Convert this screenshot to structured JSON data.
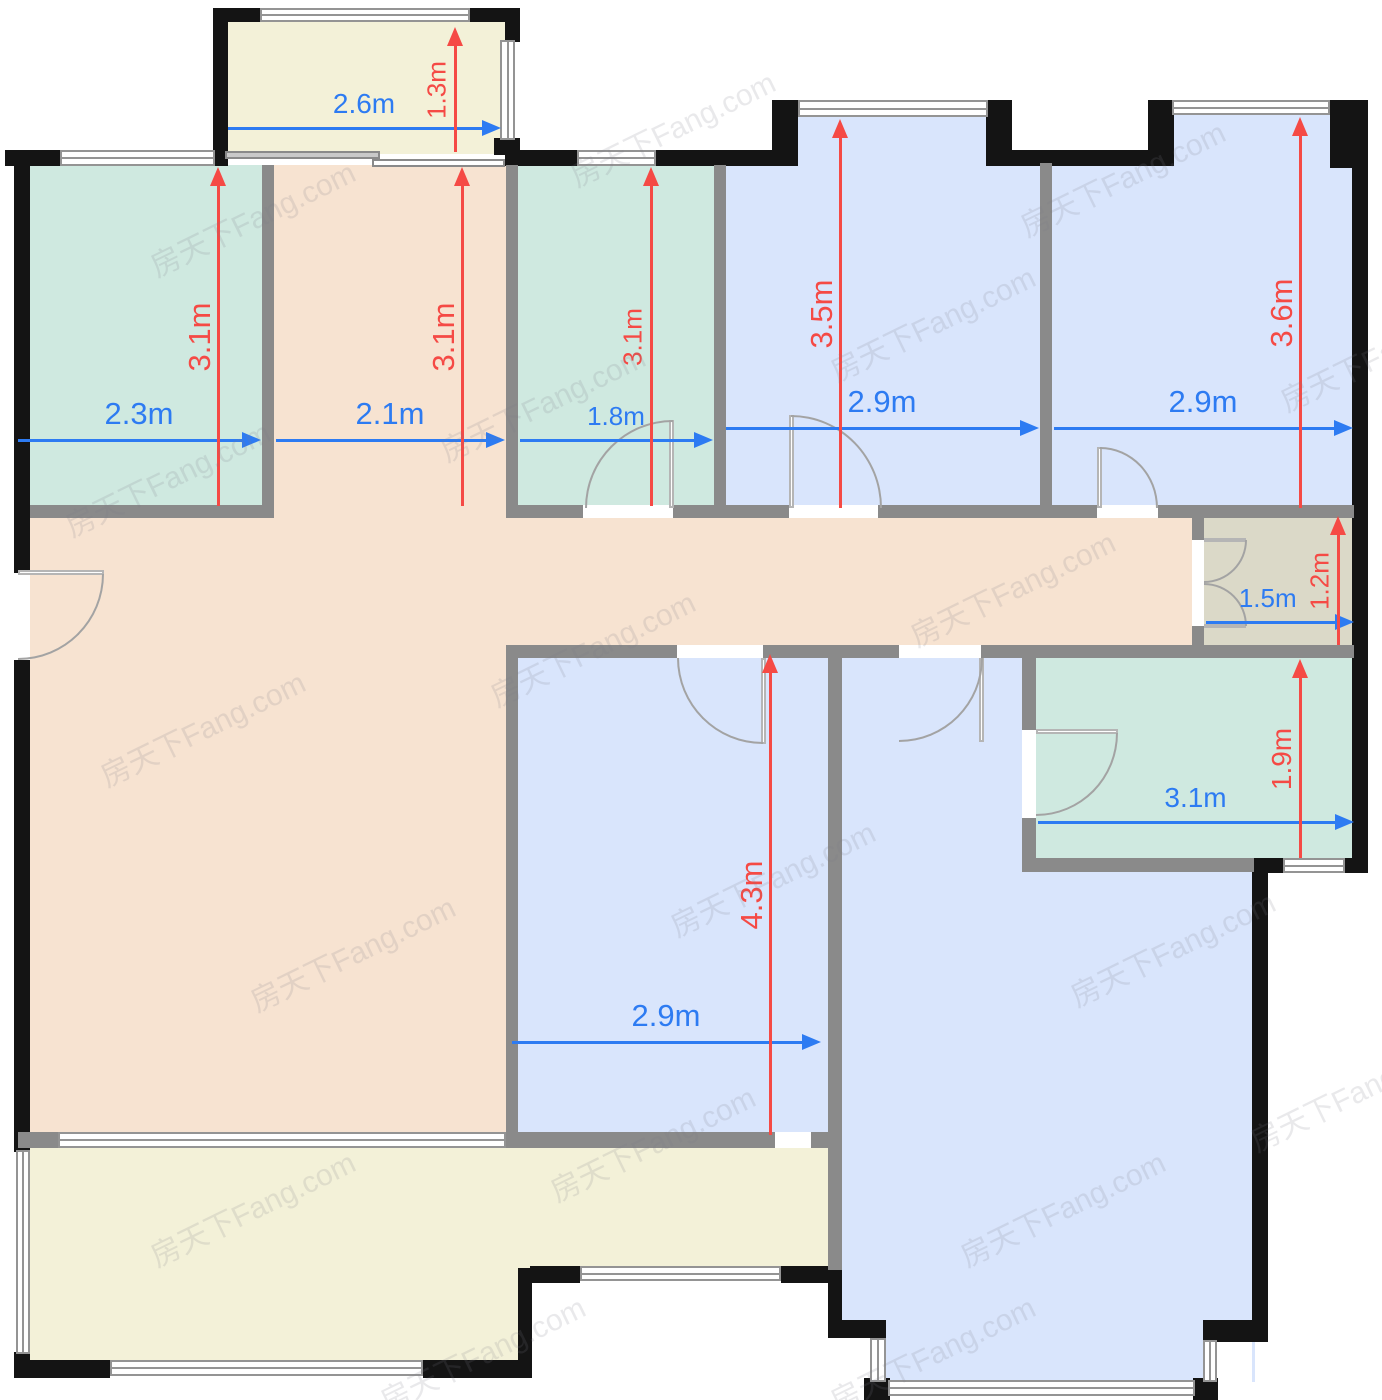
{
  "watermark": {
    "text": "房天下Fang.com"
  },
  "colors": {
    "wall_black": "#141414",
    "partition_gray": "#8a8a8a",
    "dimension_blue": "#2d7bf2",
    "dimension_red": "#f54a45",
    "room_teal": "#cfe9e0",
    "room_blue": "#d9e5fc",
    "room_peach": "#f7e3d1",
    "room_cream": "#f3f1d8",
    "room_olive": "#dbd9c8"
  },
  "dimensions": {
    "list": [
      {
        "label": "2.6m",
        "value_m": 2.6,
        "orientation": "horizontal",
        "color": "blue"
      },
      {
        "label": "1.3m",
        "value_m": 1.3,
        "orientation": "vertical",
        "color": "red"
      },
      {
        "label": "2.3m",
        "value_m": 2.3,
        "orientation": "horizontal",
        "color": "blue"
      },
      {
        "label": "3.1m",
        "value_m": 3.1,
        "orientation": "vertical",
        "color": "red"
      },
      {
        "label": "2.1m",
        "value_m": 2.1,
        "orientation": "horizontal",
        "color": "blue"
      },
      {
        "label": "3.1m",
        "value_m": 3.1,
        "orientation": "vertical",
        "color": "red"
      },
      {
        "label": "1.8m",
        "value_m": 1.8,
        "orientation": "horizontal",
        "color": "blue"
      },
      {
        "label": "3.1m",
        "value_m": 3.1,
        "orientation": "vertical",
        "color": "red"
      },
      {
        "label": "2.9m",
        "value_m": 2.9,
        "orientation": "horizontal",
        "color": "blue"
      },
      {
        "label": "3.5m",
        "value_m": 3.5,
        "orientation": "vertical",
        "color": "red"
      },
      {
        "label": "2.9m",
        "value_m": 2.9,
        "orientation": "horizontal",
        "color": "blue"
      },
      {
        "label": "3.6m",
        "value_m": 3.6,
        "orientation": "vertical",
        "color": "red"
      },
      {
        "label": "1.5m",
        "value_m": 1.5,
        "orientation": "horizontal",
        "color": "blue"
      },
      {
        "label": "1.2m",
        "value_m": 1.2,
        "orientation": "vertical",
        "color": "red"
      },
      {
        "label": "2.9m",
        "value_m": 2.9,
        "orientation": "horizontal",
        "color": "blue"
      },
      {
        "label": "4.3m",
        "value_m": 4.3,
        "orientation": "vertical",
        "color": "red"
      },
      {
        "label": "3.1m",
        "value_m": 3.1,
        "orientation": "horizontal",
        "color": "blue"
      },
      {
        "label": "1.9m",
        "value_m": 1.9,
        "orientation": "vertical",
        "color": "red"
      }
    ]
  }
}
